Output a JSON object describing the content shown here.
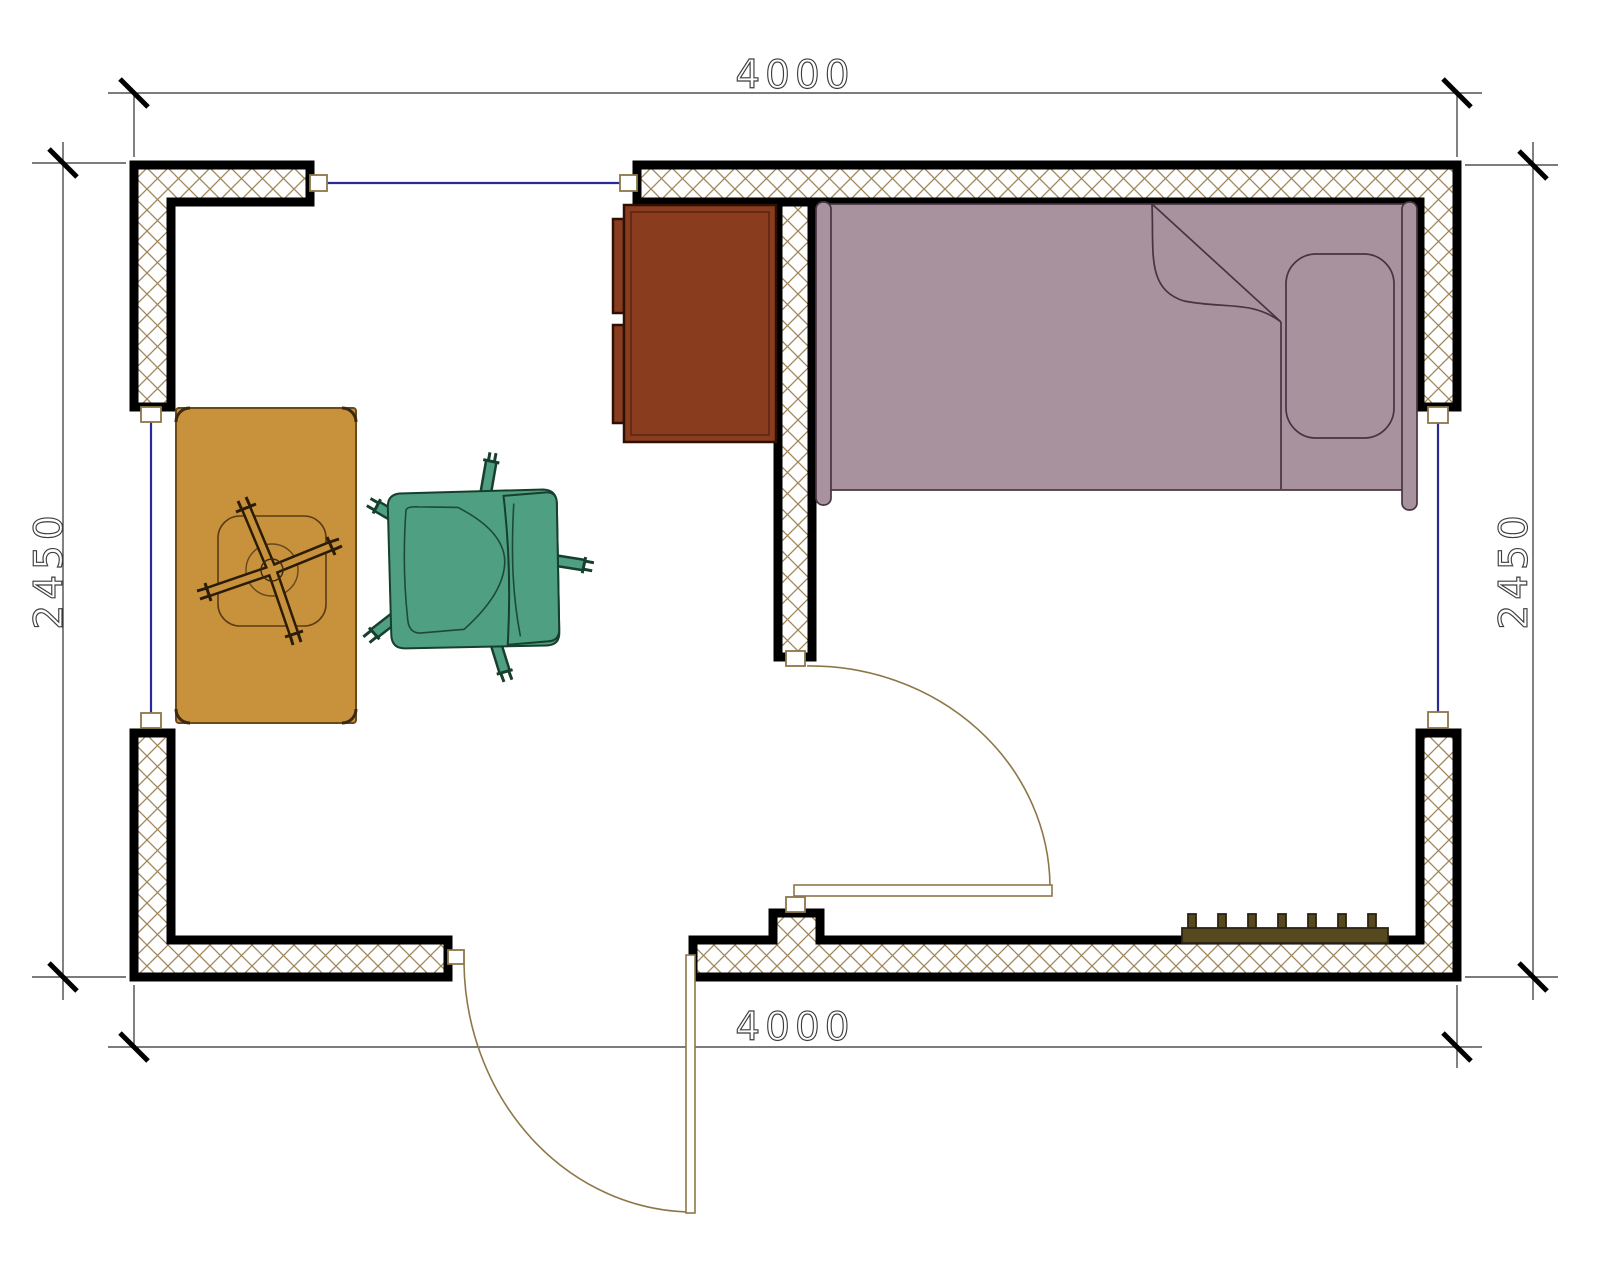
{
  "drawing": {
    "type": "architectural floor plan",
    "room": {
      "width_label_top": "4000",
      "width_label_bottom": "4000",
      "height_label_left": "2450",
      "height_label_right": "2450"
    },
    "colors": {
      "wall_outline": "#000000",
      "wall_hatch": "#a08659",
      "window_line": "#2a2a96",
      "door_line": "#8d7748",
      "dimension_line": "#2e2e2e",
      "dimension_text": "#3d3d3d",
      "bed_fill": "#a8929e",
      "bed_outline": "#463440",
      "cabinet_fill": "#8a3c1e",
      "cabinet_outline": "#2e1004",
      "table_fill": "#c8913c",
      "table_outline": "#5a3c14",
      "chair_fill": "#4f9f82",
      "chair_outline": "#173f2e",
      "radiator_fill": "#57491f"
    }
  }
}
